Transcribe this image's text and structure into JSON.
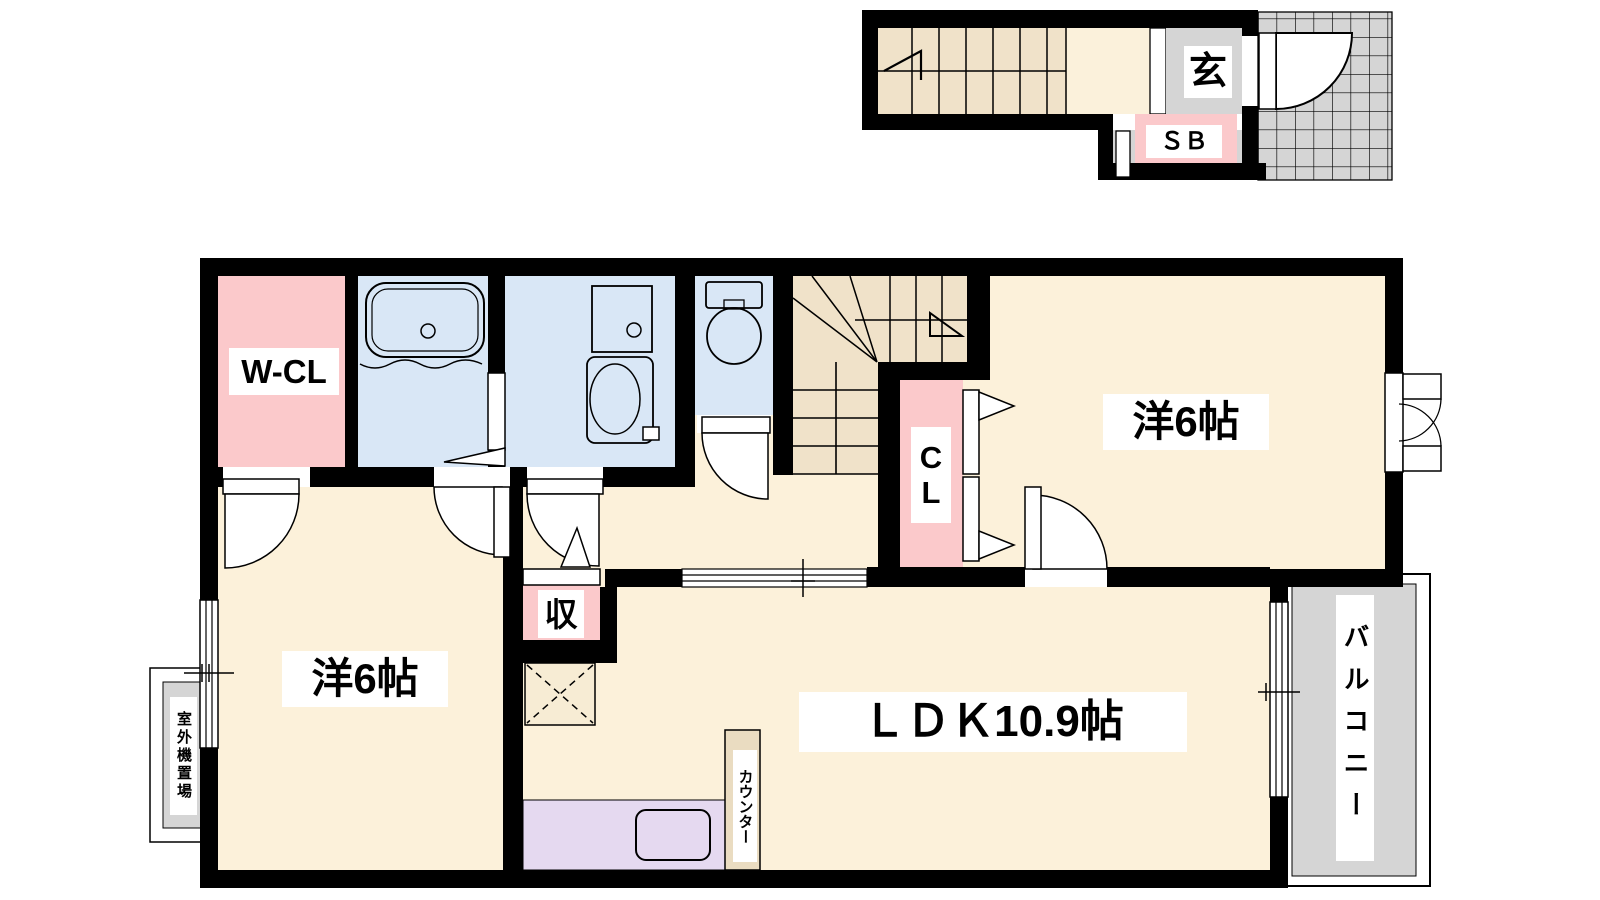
{
  "document": {
    "type": "apartment-floor-plan"
  },
  "labels": {
    "genkan": "玄",
    "shoe_box": "ＳＢ",
    "walk_in_closet": "W-CL",
    "closet": "CL",
    "bedroom_right": "洋6帖",
    "bedroom_left": "洋6帖",
    "ldk": "ＬＤＫ10.9帖",
    "storage": "収",
    "kitchen_counter": "カウンター",
    "balcony": "バルコニー",
    "outdoor_unit": "室外機置場"
  },
  "colors": {
    "wall_black": "#000000",
    "floor_cream": "#FCF1DA",
    "stair_tan": "#F0E2C9",
    "room_pink": "#FBC9CB",
    "wet_area_blue": "#D9E7F6",
    "kitchen_lavender": "#E5D9F0",
    "gray_area": "#D5D5D5",
    "counter_tan": "#EADCC1"
  }
}
